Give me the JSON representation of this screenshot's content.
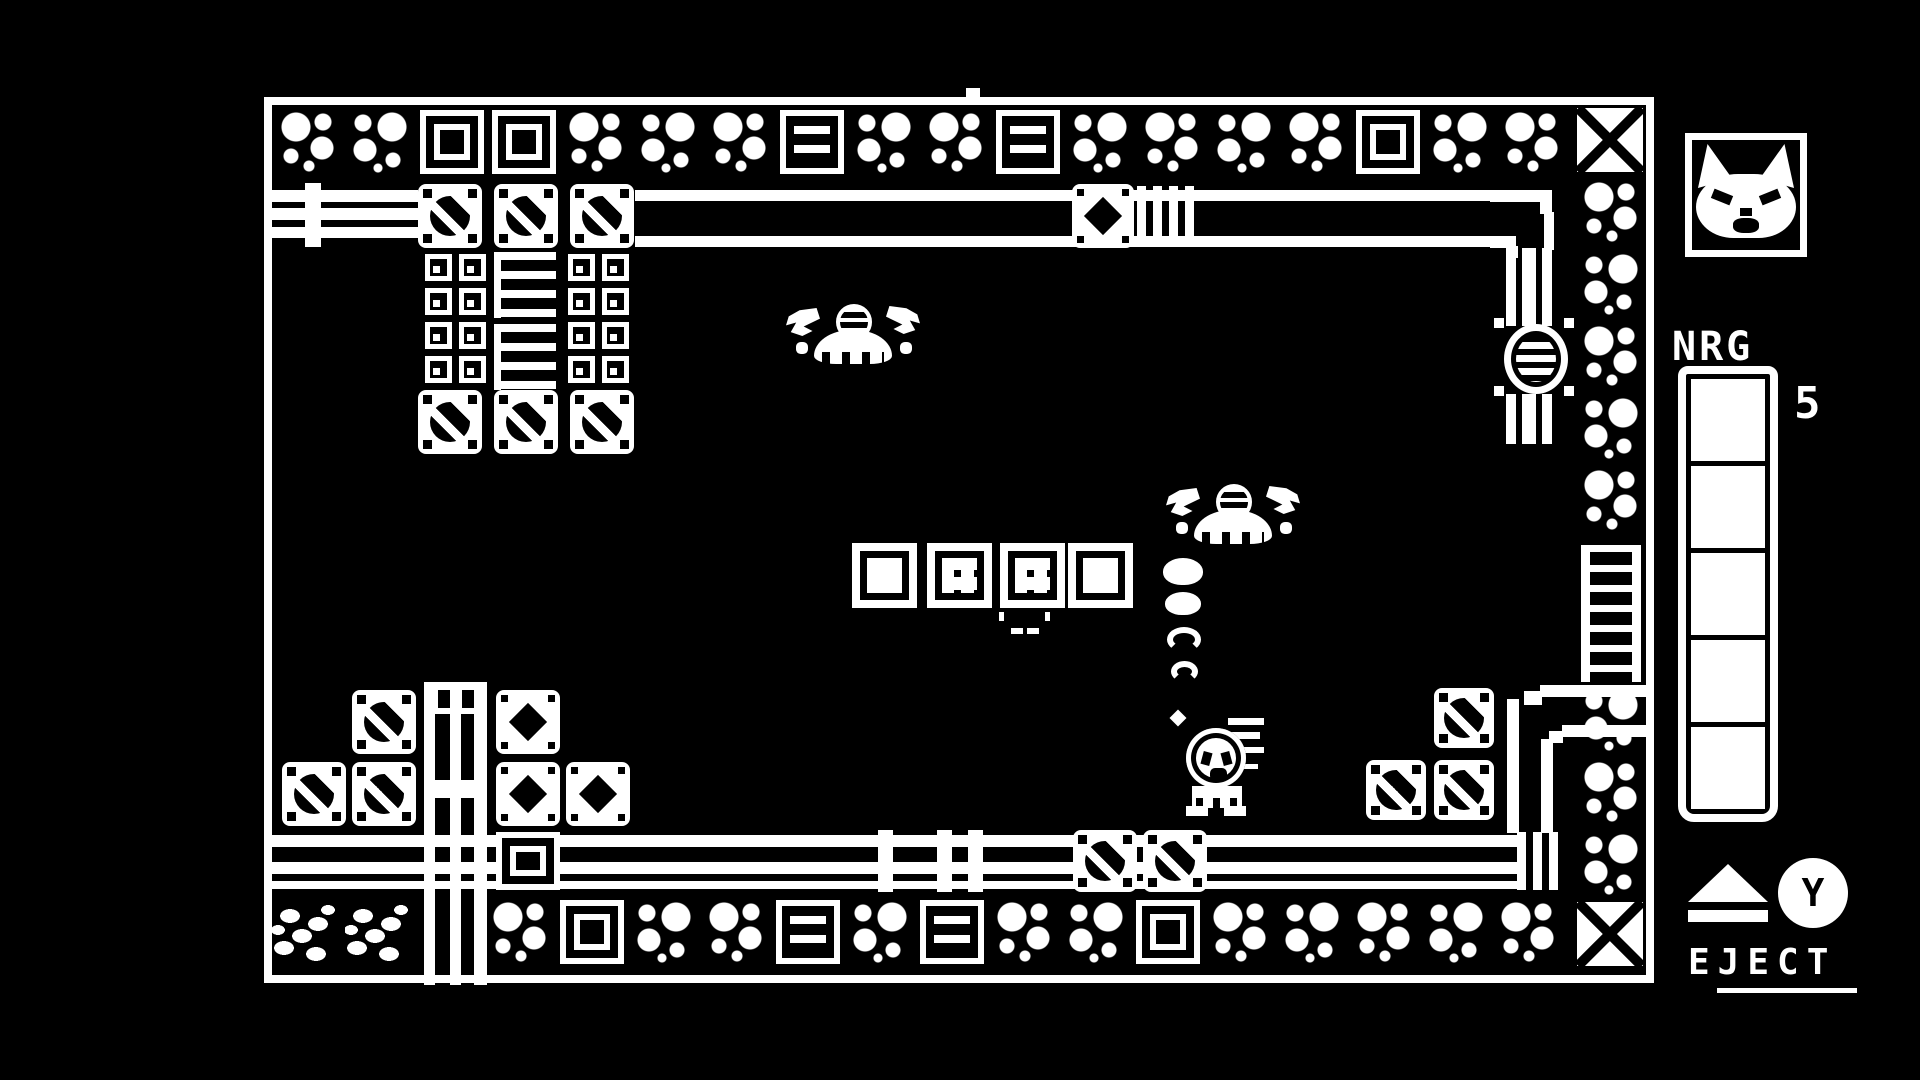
{
  "colors": {
    "foreground": "#ffffff",
    "background": "#000000"
  },
  "hud": {
    "portrait_icon": "cat-face",
    "nrg_label": "NRG",
    "nrg_value": "5",
    "nrg_segments_total": 5,
    "nrg_segments_filled": 5,
    "eject_icon": "eject-triangle",
    "action_button_label": "Y",
    "eject_label": "EJECT"
  },
  "scene": {
    "player": {
      "x": 1186,
      "y": 710,
      "sprite": "mech-with-cat-pilot"
    },
    "enemies": [
      {
        "x": 786,
        "y": 304,
        "sprite": "flying-crab"
      },
      {
        "x": 1166,
        "y": 484,
        "sprite": "flying-crab"
      }
    ],
    "tile_rows": [
      {
        "name": "top-border",
        "x": 276,
        "y": 110,
        "w": 64,
        "h": 64,
        "pitch": 72,
        "vertical": false,
        "tiles": [
          "bubble-a",
          "bubble-b",
          "plate",
          "plate",
          "bubble-a",
          "bubble-b",
          "bubble-a",
          "slat",
          "bubble-b",
          "bubble-a",
          "slat",
          "bubble-b",
          "bubble-a",
          "bubble-b",
          "bubble-a",
          "plate",
          "bubble-b",
          "bubble-a"
        ]
      },
      {
        "name": "bottom-border",
        "x": 488,
        "y": 900,
        "w": 64,
        "h": 64,
        "pitch": 72,
        "vertical": false,
        "tiles": [
          "bubble-a",
          "plate",
          "bubble-b",
          "bubble-a",
          "slat",
          "bubble-b",
          "slat",
          "bubble-a",
          "bubble-b",
          "plate",
          "bubble-a",
          "bubble-b",
          "bubble-a",
          "bubble-b",
          "bubble-a"
        ]
      },
      {
        "name": "right-border-upper",
        "x": 1579,
        "y": 180,
        "w": 64,
        "h": 64,
        "pitch": 72,
        "vertical": true,
        "tiles": [
          "bubble-a",
          "bubble-b",
          "bubble-a",
          "bubble-b",
          "bubble-a"
        ]
      },
      {
        "name": "right-border-lower",
        "x": 1579,
        "y": 688,
        "w": 64,
        "h": 64,
        "pitch": 72,
        "vertical": true,
        "tiles": [
          "bubble-b",
          "bubble-a",
          "bubble-b"
        ]
      }
    ],
    "sprites": [
      {
        "t": "x-tile",
        "x": 1577,
        "y": 108,
        "w": 66,
        "h": 64,
        "n": "corner-x-tile"
      },
      {
        "t": "x-tile",
        "x": 1577,
        "y": 902,
        "w": 66,
        "h": 64,
        "n": "corner-x-tile"
      },
      {
        "t": "pebble",
        "x": 272,
        "y": 902,
        "w": 72,
        "h": 66,
        "n": "pebble-tile"
      },
      {
        "t": "pebble",
        "x": 345,
        "y": 902,
        "w": 72,
        "h": 66,
        "n": "pebble-tile"
      },
      {
        "t": "wrect",
        "x": 966,
        "y": 88,
        "w": 14,
        "h": 10,
        "n": "door-marker"
      },
      {
        "t": "screw",
        "x": 418,
        "y": 184,
        "w": 64,
        "h": 64
      },
      {
        "t": "screw",
        "x": 494,
        "y": 184,
        "w": 64,
        "h": 64
      },
      {
        "t": "screw",
        "x": 570,
        "y": 184,
        "w": 64,
        "h": 64
      },
      {
        "t": "screw",
        "x": 418,
        "y": 390,
        "w": 64,
        "h": 64
      },
      {
        "t": "screw",
        "x": 494,
        "y": 390,
        "w": 64,
        "h": 64
      },
      {
        "t": "screw",
        "x": 570,
        "y": 390,
        "w": 64,
        "h": 64
      },
      {
        "t": "screw",
        "x": 352,
        "y": 690,
        "w": 64,
        "h": 64
      },
      {
        "t": "screw",
        "x": 282,
        "y": 762,
        "w": 64,
        "h": 64
      },
      {
        "t": "screw",
        "x": 352,
        "y": 762,
        "w": 64,
        "h": 64
      },
      {
        "t": "screw",
        "x": 1073,
        "y": 830,
        "w": 64,
        "h": 62
      },
      {
        "t": "screw",
        "x": 1143,
        "y": 830,
        "w": 64,
        "h": 62
      },
      {
        "t": "screw",
        "x": 1434,
        "y": 688,
        "w": 60,
        "h": 60
      },
      {
        "t": "screw",
        "x": 1366,
        "y": 760,
        "w": 60,
        "h": 60
      },
      {
        "t": "screw",
        "x": 1434,
        "y": 760,
        "w": 60,
        "h": 60
      },
      {
        "t": "smallsq",
        "x": 425,
        "y": 254,
        "w": 27,
        "h": 27
      },
      {
        "t": "smallsq",
        "x": 459,
        "y": 254,
        "w": 27,
        "h": 27
      },
      {
        "t": "smallsq",
        "x": 568,
        "y": 254,
        "w": 27,
        "h": 27
      },
      {
        "t": "smallsq",
        "x": 602,
        "y": 254,
        "w": 27,
        "h": 27
      },
      {
        "t": "smallsq",
        "x": 425,
        "y": 288,
        "w": 27,
        "h": 27
      },
      {
        "t": "smallsq",
        "x": 459,
        "y": 288,
        "w": 27,
        "h": 27
      },
      {
        "t": "smallsq",
        "x": 568,
        "y": 288,
        "w": 27,
        "h": 27
      },
      {
        "t": "smallsq",
        "x": 602,
        "y": 288,
        "w": 27,
        "h": 27
      },
      {
        "t": "smallsq",
        "x": 425,
        "y": 322,
        "w": 27,
        "h": 27
      },
      {
        "t": "smallsq",
        "x": 459,
        "y": 322,
        "w": 27,
        "h": 27
      },
      {
        "t": "smallsq",
        "x": 568,
        "y": 322,
        "w": 27,
        "h": 27
      },
      {
        "t": "smallsq",
        "x": 602,
        "y": 322,
        "w": 27,
        "h": 27
      },
      {
        "t": "smallsq",
        "x": 425,
        "y": 356,
        "w": 27,
        "h": 27
      },
      {
        "t": "smallsq",
        "x": 459,
        "y": 356,
        "w": 27,
        "h": 27
      },
      {
        "t": "smallsq",
        "x": 568,
        "y": 356,
        "w": 27,
        "h": 27
      },
      {
        "t": "smallsq",
        "x": 602,
        "y": 356,
        "w": 27,
        "h": 27
      },
      {
        "t": "vstripe",
        "x": 494,
        "y": 252,
        "w": 62,
        "h": 66
      },
      {
        "t": "vstripe",
        "x": 494,
        "y": 324,
        "w": 62,
        "h": 66
      },
      {
        "t": "plated",
        "x": 1072,
        "y": 184,
        "w": 62,
        "h": 64
      },
      {
        "t": "plated",
        "x": 496,
        "y": 690,
        "w": 64,
        "h": 64
      },
      {
        "t": "plated",
        "x": 496,
        "y": 762,
        "w": 64,
        "h": 64
      },
      {
        "t": "plated",
        "x": 566,
        "y": 762,
        "w": 64,
        "h": 64
      },
      {
        "t": "plate",
        "x": 496,
        "y": 832,
        "w": 64,
        "h": 58
      },
      {
        "t": "crate",
        "x": 852,
        "y": 543,
        "w": 65,
        "h": 65
      },
      {
        "t": "crateb",
        "x": 927,
        "y": 543,
        "w": 65,
        "h": 65
      },
      {
        "t": "crateb",
        "x": 1000,
        "y": 543,
        "w": 65,
        "h": 65
      },
      {
        "t": "crate",
        "x": 1068,
        "y": 543,
        "w": 65,
        "h": 65
      },
      {
        "t": "coupling",
        "x": 305,
        "y": 183,
        "w": 16,
        "h": 64
      },
      {
        "t": "coupling",
        "x": 878,
        "y": 830,
        "w": 15,
        "h": 62
      },
      {
        "t": "coupling",
        "x": 937,
        "y": 830,
        "w": 15,
        "h": 62
      },
      {
        "t": "coupling",
        "x": 968,
        "y": 830,
        "w": 15,
        "h": 62
      },
      {
        "t": "ribbed",
        "x": 1137,
        "y": 186,
        "w": 64,
        "h": 60
      },
      {
        "t": "ribbed",
        "x": 1517,
        "y": 832,
        "w": 46,
        "h": 58
      },
      {
        "t": "ladder",
        "x": 1581,
        "y": 545,
        "w": 60,
        "h": 137
      },
      {
        "t": "tick",
        "x": 999,
        "y": 612,
        "w": 5,
        "h": 9
      },
      {
        "t": "tick",
        "x": 1045,
        "y": 612,
        "w": 5,
        "h": 9
      },
      {
        "t": "dash",
        "x": 1011,
        "y": 628,
        "w": 12,
        "h": 6
      },
      {
        "t": "dash",
        "x": 1027,
        "y": 628,
        "w": 12,
        "h": 6
      },
      {
        "t": "dot",
        "x": 1172,
        "y": 712,
        "w": 12,
        "h": 12,
        "n": "smoke-dot"
      },
      {
        "t": "puff-solid",
        "x": 1163,
        "y": 558,
        "w": 40,
        "h": 27,
        "n": "smoke-puff"
      },
      {
        "t": "puff-solid",
        "x": 1165,
        "y": 592,
        "w": 36,
        "h": 23,
        "n": "smoke-puff"
      },
      {
        "t": "puff-ring",
        "x": 1167,
        "y": 627,
        "w": 34,
        "h": 25,
        "n": "smoke-puff"
      },
      {
        "t": "puff-ring",
        "x": 1171,
        "y": 661,
        "w": 27,
        "h": 21,
        "n": "smoke-puff"
      },
      {
        "t": "wrect",
        "x": 1494,
        "y": 318,
        "w": 10,
        "h": 10,
        "n": "valve-bracket"
      },
      {
        "t": "wrect",
        "x": 1564,
        "y": 318,
        "w": 10,
        "h": 10,
        "n": "valve-bracket"
      },
      {
        "t": "wrect",
        "x": 1494,
        "y": 386,
        "w": 10,
        "h": 10,
        "n": "valve-bracket"
      },
      {
        "t": "wrect",
        "x": 1564,
        "y": 386,
        "w": 10,
        "h": 10,
        "n": "valve-bracket"
      }
    ]
  }
}
